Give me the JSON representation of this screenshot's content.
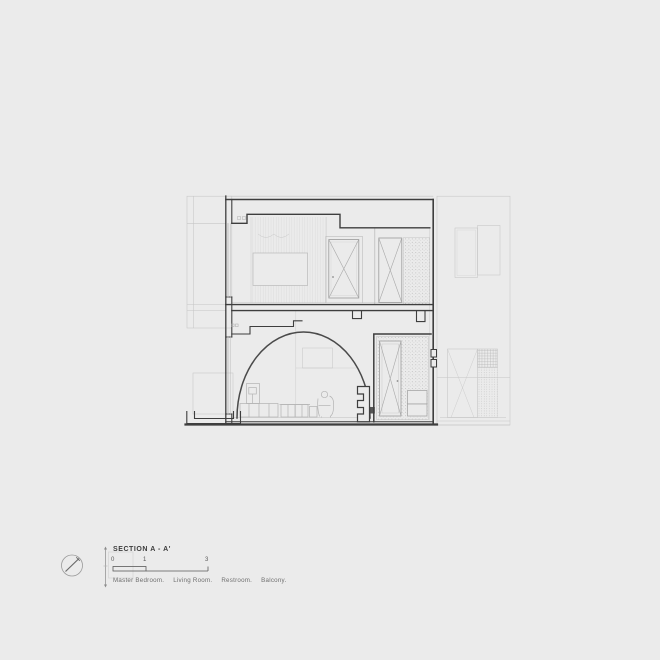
{
  "title_block": {
    "title": "SECTION A - A'",
    "scale_ticks": [
      "0",
      "1",
      "3"
    ],
    "rooms": [
      "Master Bedroom.",
      "Living Room.",
      "Restroom.",
      "Balcony."
    ]
  },
  "colors": {
    "background": "#ebebeb",
    "line_dark": "#3e3e3e",
    "line_medium": "#9b9b9b",
    "line_light": "#c6c6c6",
    "text_dark": "#3c3c3c",
    "text_gray": "#6f6f6f"
  }
}
